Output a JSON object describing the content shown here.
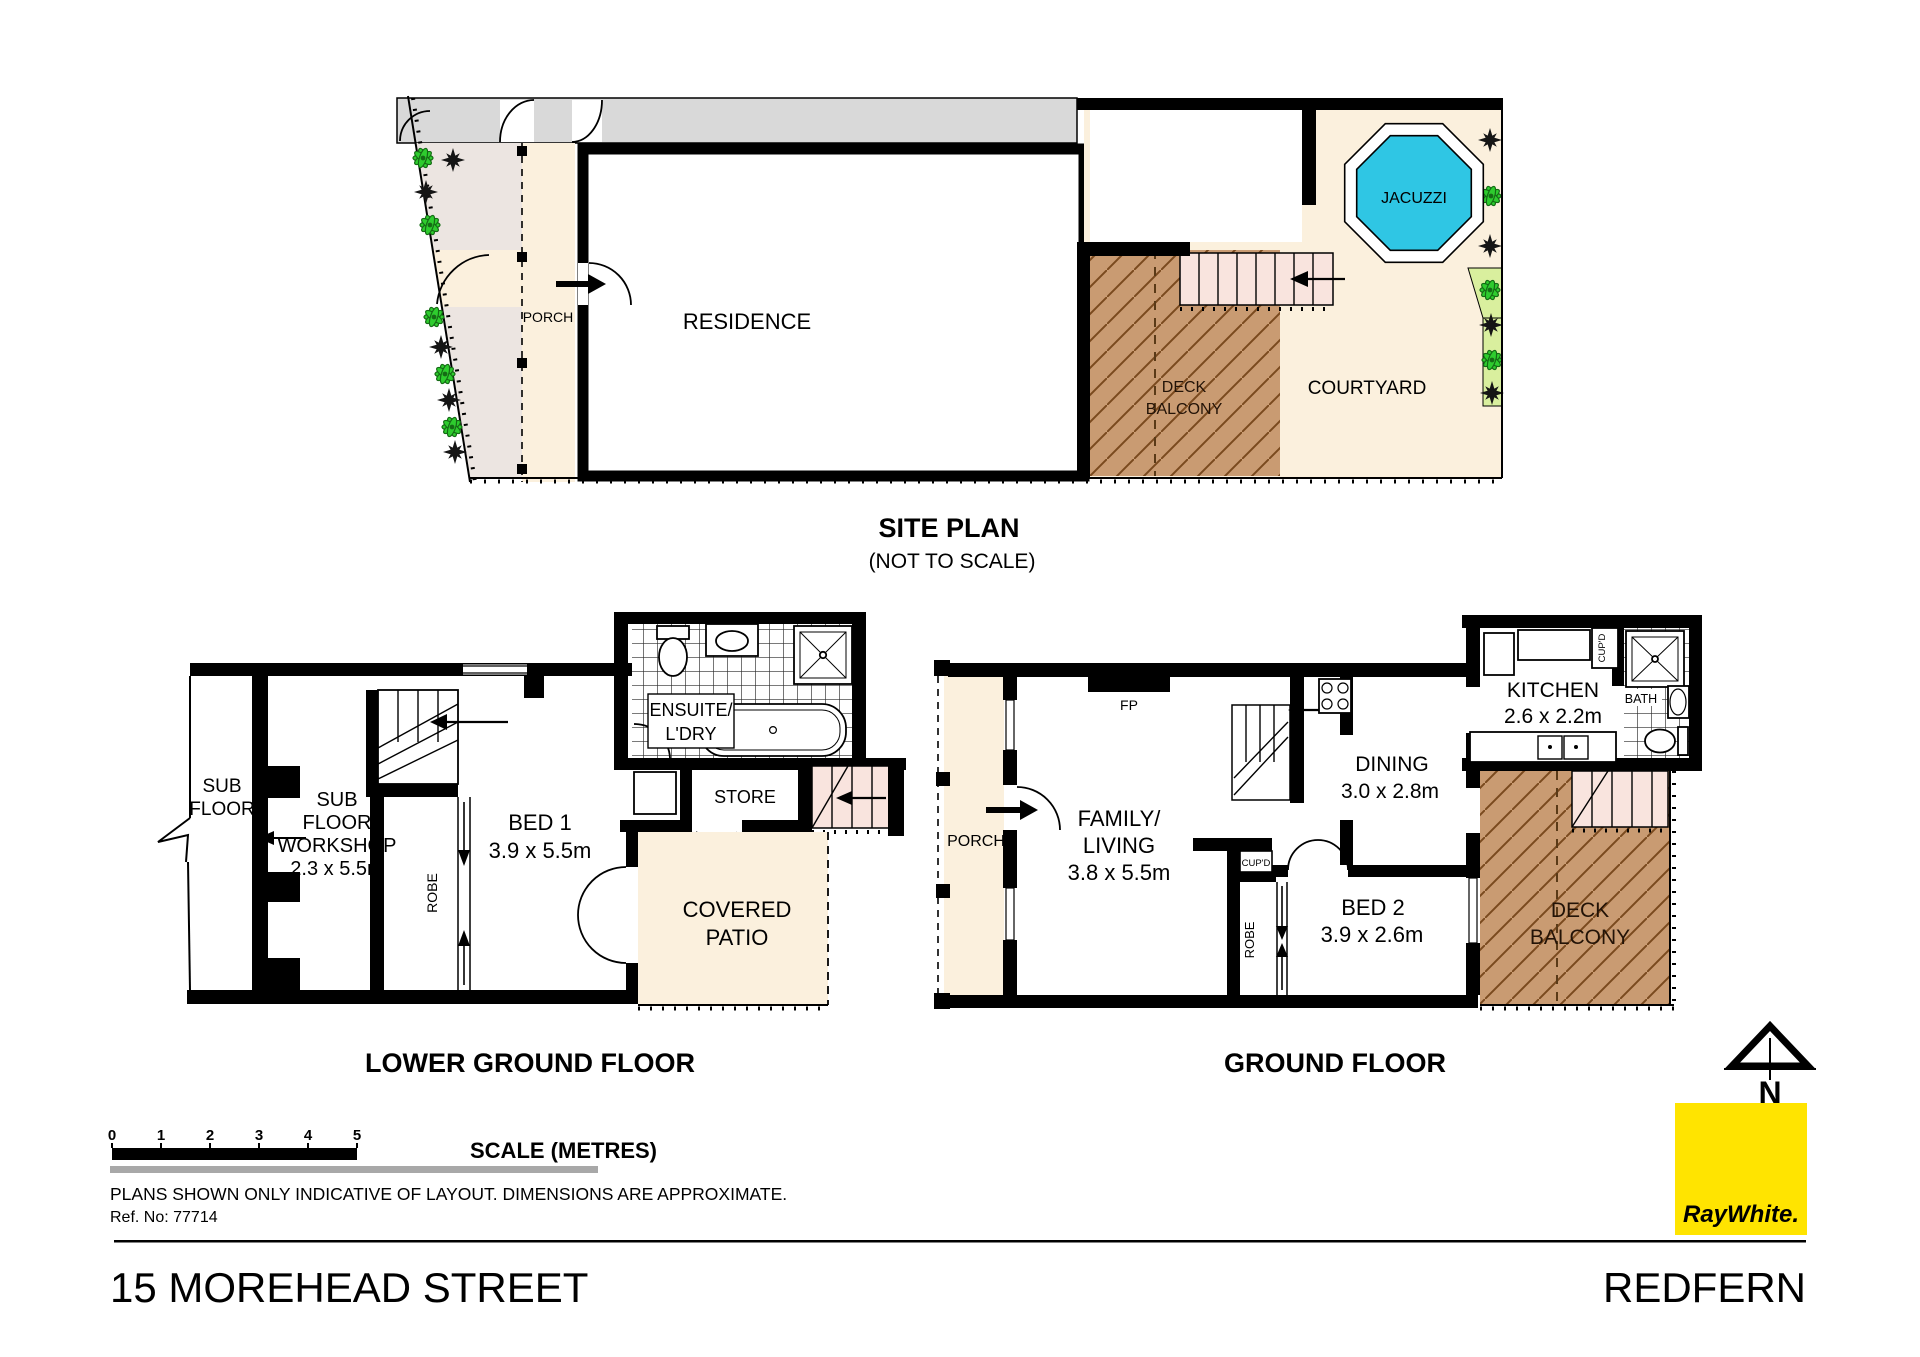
{
  "page": {
    "address": "15 MOREHEAD STREET",
    "suburb": "REDFERN",
    "disclaimer": "PLANS SHOWN ONLY INDICATIVE OF LAYOUT.  DIMENSIONS ARE APPROXIMATE.",
    "ref": "Ref. No: 77714"
  },
  "titles": {
    "site": "SITE PLAN",
    "site_sub": "(NOT TO SCALE)",
    "lower": "LOWER GROUND FLOOR",
    "ground": "GROUND FLOOR"
  },
  "scale_bar": {
    "label": "SCALE (METRES)",
    "ticks": [
      "0",
      "1",
      "2",
      "3",
      "4",
      "5"
    ]
  },
  "site": {
    "residence": "RESIDENCE",
    "porch": "PORCH",
    "deck": [
      "DECK",
      "BALCONY"
    ],
    "courtyard": "COURTYARD",
    "jacuzzi": "JACUZZI"
  },
  "lower": {
    "subfloor": [
      "SUB",
      "FLOOR"
    ],
    "workshop": [
      "SUB",
      "FLOOR",
      "WORKSHOP",
      "2.3 x 5.5m"
    ],
    "robe": "ROBE",
    "bed1": [
      "BED 1",
      "3.9 x 5.5m"
    ],
    "ensuite": [
      "ENSUITE/",
      "L'DRY"
    ],
    "store": "STORE",
    "patio": [
      "COVERED",
      "PATIO"
    ]
  },
  "ground": {
    "porch": "PORCH",
    "fp": "FP",
    "family": [
      "FAMILY/",
      "LIVING",
      "3.8 x 5.5m"
    ],
    "dining": [
      "DINING",
      "3.0 x 2.8m"
    ],
    "kitchen": [
      "KITCHEN",
      "2.6 x 2.2m"
    ],
    "cupd_hall": "CUP'D",
    "cupd_kitchen": "CUP'D",
    "robe": "ROBE",
    "bed2": [
      "BED 2",
      "3.9 x 2.6m"
    ],
    "bath": "BATH",
    "deck": [
      "DECK",
      "BALCONY"
    ]
  },
  "branding": {
    "logo": "RayWhite.",
    "north": "N"
  },
  "colors": {
    "cream": "#fbf0dd",
    "garden": "#ece5e1",
    "band_gray": "#d9d9d9",
    "deck_tan": "#c99b72",
    "deck_line": "#7a4a1e",
    "stair_pink": "#f9e4de",
    "jacuzzi_cyan": "#2fc6e4",
    "lawn_green": "#d9ef9e",
    "plant_green": "#2ecc2e",
    "logo_yellow": "#ffe400",
    "logo_text": "#4d4d4f"
  }
}
